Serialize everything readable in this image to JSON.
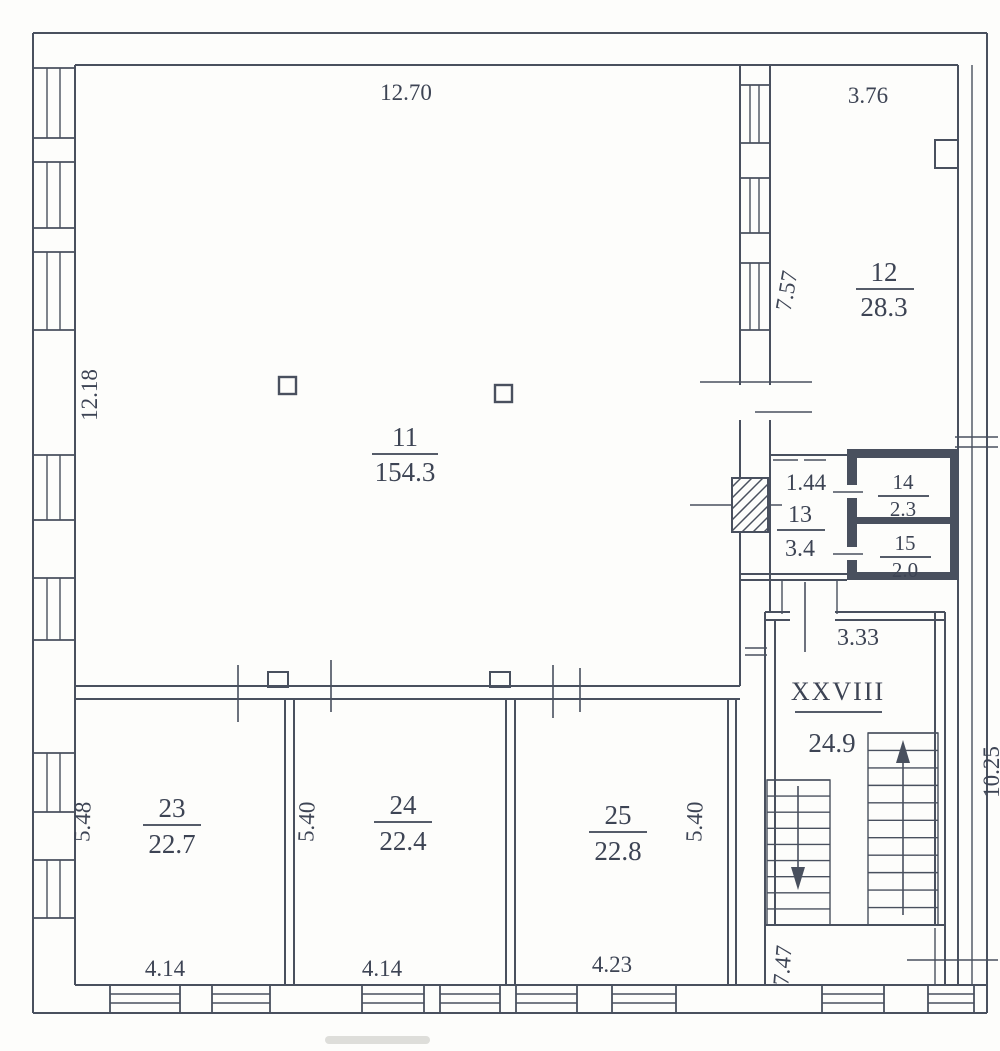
{
  "plan": {
    "type": "bti-floor-plan",
    "rooms": {
      "r11": {
        "number": "11",
        "area": "154.3"
      },
      "r12": {
        "number": "12",
        "area": "28.3"
      },
      "r13": {
        "number": "13",
        "area": "3.4"
      },
      "r14": {
        "number": "14",
        "area": "2.3"
      },
      "r15": {
        "number": "15",
        "area": "2.0"
      },
      "stair": {
        "number": "XXVIII",
        "area": "24.9"
      },
      "r23": {
        "number": "23",
        "area": "22.7"
      },
      "r24": {
        "number": "24",
        "area": "22.4"
      },
      "r25": {
        "number": "25",
        "area": "22.8"
      }
    },
    "dimensions": {
      "top_width": "12.70",
      "top_right_width": "3.76",
      "left_height": "12.18",
      "room12_height": "7.57",
      "room13_width": "1.44",
      "stair_width": "3.33",
      "room23_height": "5.48",
      "room24_height": "5.40",
      "room25_height": "5.40",
      "room23_width": "4.14",
      "room24_width": "4.14",
      "room25_width": "4.23",
      "stair_lower_height": "7.47",
      "right_edge_partial": "10.25"
    },
    "symbols": {
      "stair_up_arrow": "up",
      "stair_down_arrow": "down",
      "vent_shaft": "hatched",
      "columns": 2
    },
    "colors": {
      "line": "#49505e",
      "text": "#3d4454",
      "background": "#fdfdfb"
    }
  }
}
